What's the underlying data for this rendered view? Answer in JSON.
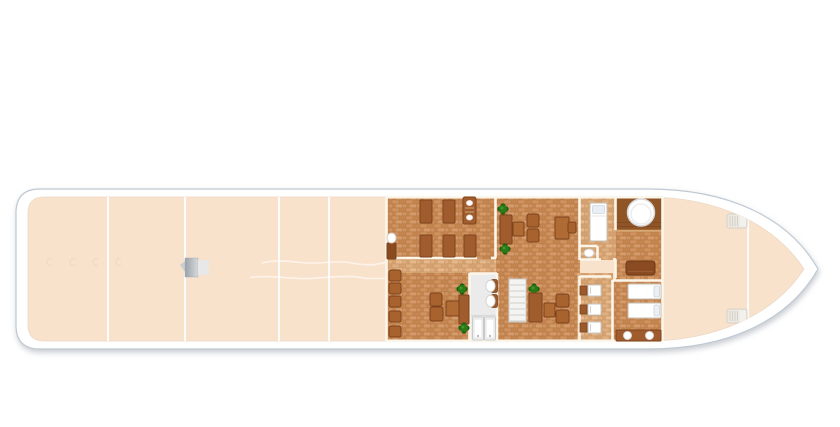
{
  "title": "river-ship-deck-floor-plan",
  "colors": {
    "page_bg": "#ffffff",
    "hull": "#ffffff",
    "hull_outline": "#bfc9d2",
    "deck": "#f9e2cc",
    "deck_line": "#ffffff",
    "deck_edge": "#ecd9c4",
    "wall": "#fcf6ea",
    "brick_medium_mortar": "#b87c48",
    "brick_medium_1": "#cf9260",
    "brick_medium_2": "#c5854f",
    "brick_medium_3": "#d49a6a",
    "brick_light_mortar": "#c99a68",
    "brick_light_1": "#e0af80",
    "brick_light_2": "#d6a170",
    "brick_light_3": "#e6b88c",
    "platform_dark": "#8f5527",
    "platform_plank": "#7c471f",
    "platform_edge": "#d8a873",
    "wood": "#a05c2c",
    "wood_dark": "#7d431c",
    "wood_chair": "#a7622e",
    "wood_table": "#b06a33",
    "wood_cabinet": "#8a4a1f",
    "sofa": "#8a4a22",
    "plant_green": "#2a7a18",
    "plant_green_dark": "#1e5c10",
    "white_fixture": "#ffffff",
    "fixture_stroke": "#c6beb2",
    "pillow_blue": "#e9eef4",
    "wc_floor": "#ebebeb",
    "stairs_fill": "#f4f4f2",
    "stairs_line": "#d2cec6",
    "winch_gray_1": "#9aa1a7",
    "winch_gray_2": "#d7dadd",
    "hatch_fill": "#ece9e2",
    "hatch_stroke": "#d6d1c7",
    "tie_mark": "#eed9bf"
  },
  "floorplan": {
    "canvas": {
      "w": 840,
      "h": 427
    },
    "ship": {
      "outer_path": "M 40,189 H 648 C 726,189 788,216 818,269 C 788,322 726,349 648,349 H 40 Q 16,349 16,325 V 213 Q 16,189 40,189 Z",
      "deck_path": "M 44,197 H 646 C 716,197 774,223 804,269 C 774,315 716,341 646,341 H 44 Q 28,341 28,325 V 213 Q 28,197 44,197 Z"
    },
    "deck": {
      "divider_x": [
        108,
        185,
        279,
        329
      ],
      "bow_line": {
        "x": 748,
        "y1": 210,
        "y2": 330
      },
      "lane_lines": [
        "M 262,263 c 15,-4 30,-1 45,0 s 30,-3 45,0 s 25,2 34,-1",
        "M 250,277.5 c 20,-3 40,2 60,1 s 40,-4 56,0 l 20,0"
      ],
      "tie_marks": [
        [
          50,
          262
        ],
        [
          73,
          262
        ],
        [
          96,
          262
        ],
        [
          119,
          262
        ]
      ],
      "winch": {
        "x": 185,
        "y": 258
      },
      "hatches": [
        [
          727,
          214
        ],
        [
          727,
          309
        ]
      ]
    },
    "rooms": [
      {
        "name": "saloon-benches-room",
        "floor": "medium",
        "rect": [
          387,
          197,
          109,
          62
        ]
      },
      {
        "name": "corridor-left",
        "floor": "light",
        "rect": [
          387,
          259,
          109,
          14
        ]
      },
      {
        "name": "lounge-lower-room",
        "floor": "medium",
        "rect": [
          387,
          273,
          109,
          68
        ]
      },
      {
        "name": "lounge-main-room",
        "floor": "medium",
        "rect": [
          496,
          197,
          84,
          144
        ]
      },
      {
        "name": "cabin",
        "floor": "light",
        "rect": [
          580,
          197,
          36,
          63
        ]
      },
      {
        "name": "aft-platform",
        "floor": "dark",
        "rect": [
          616,
          197,
          47,
          33
        ]
      },
      {
        "name": "sofa-area",
        "floor": "medium",
        "rect": [
          616,
          230,
          47,
          50
        ]
      },
      {
        "name": "corridor-right",
        "floor": "light",
        "rect": [
          577,
          273,
          36,
          68
        ]
      },
      {
        "name": "bedroom",
        "floor": "medium",
        "rect": [
          613,
          280,
          50,
          61
        ]
      },
      {
        "name": "washroom",
        "floor": "white",
        "rect": [
          470,
          273,
          27,
          68
        ]
      }
    ],
    "walls": [
      [
        386.5,
        197,
        386.5,
        341
      ],
      [
        387,
        258,
        477,
        258
      ],
      [
        491,
        258,
        496,
        258
      ],
      [
        495.5,
        197,
        495.5,
        258
      ],
      [
        579.5,
        197,
        579.5,
        260
      ],
      [
        580,
        246,
        597,
        246
      ],
      [
        597.5,
        246,
        597.5,
        260
      ],
      [
        580,
        259.5,
        601,
        259.5
      ],
      [
        613,
        259.5,
        616,
        259.5
      ],
      [
        615.5,
        197,
        615.5,
        230
      ],
      [
        615.5,
        259,
        615.5,
        278
      ],
      [
        579.5,
        276,
        579.5,
        341
      ],
      [
        579.5,
        276.5,
        611,
        276.5
      ],
      [
        612.5,
        280,
        612.5,
        341
      ],
      [
        612.5,
        280.5,
        663,
        280.5
      ],
      [
        469.5,
        273,
        469.5,
        341
      ],
      [
        497,
        273,
        497,
        341
      ],
      [
        469.5,
        273.5,
        497,
        273.5
      ],
      [
        386,
        340.8,
        663,
        340.8
      ],
      [
        386,
        197.2,
        663,
        197.2
      ],
      [
        662.5,
        197,
        662.5,
        341
      ]
    ],
    "thin_lines": [
      {
        "x1": 616,
        "y1": 222.5,
        "x2": 663,
        "y2": 222.5,
        "color": "#7c471f",
        "w": 0.8
      },
      {
        "x1": 616,
        "y1": 226.5,
        "x2": 663,
        "y2": 226.5,
        "color": "#7c471f",
        "w": 0.8
      },
      {
        "x1": 616,
        "y1": 230.8,
        "x2": 663,
        "y2": 230.8,
        "color": "#d8a873",
        "w": 2
      },
      {
        "x1": 470,
        "y1": 315.5,
        "x2": 497,
        "y2": 315.5,
        "color": "#d9d9d9",
        "w": 1.2
      }
    ],
    "furniture": [
      {
        "t": "bench",
        "r": [
          420,
          200,
          12,
          23
        ]
      },
      {
        "t": "bench",
        "r": [
          443,
          200,
          12,
          23
        ]
      },
      {
        "t": "lounger",
        "r": [
          463,
          197,
          13,
          27
        ]
      },
      {
        "t": "bench",
        "r": [
          420,
          235,
          12,
          22
        ]
      },
      {
        "t": "bench",
        "r": [
          443,
          235,
          12,
          22
        ]
      },
      {
        "t": "bench",
        "r": [
          464,
          235,
          12,
          22
        ]
      },
      {
        "t": "cabinet",
        "r": [
          387,
          243,
          9,
          16
        ]
      },
      {
        "t": "oval-table",
        "c": [
          391.5,
          238,
          4.5,
          5
        ]
      },
      {
        "t": "plant",
        "c": [
          503,
          209
        ]
      },
      {
        "t": "bench",
        "r": [
          500,
          215,
          12,
          29
        ]
      },
      {
        "t": "plant",
        "c": [
          505,
          249
        ]
      },
      {
        "t": "table",
        "r": [
          513,
          222,
          11,
          14
        ]
      },
      {
        "t": "chair",
        "r": [
          527,
          214,
          12,
          13
        ]
      },
      {
        "t": "chair",
        "r": [
          527,
          229,
          12,
          13
        ]
      },
      {
        "t": "table",
        "r": [
          555,
          217,
          14,
          22
        ]
      },
      {
        "t": "chair",
        "r": [
          568,
          222,
          8,
          11
        ]
      },
      {
        "t": "bed-v",
        "r": [
          590,
          203,
          17,
          38
        ]
      },
      {
        "t": "sink",
        "c": [
          589,
          253,
          5,
          4
        ]
      },
      {
        "t": "tub",
        "c": [
          641,
          212.5,
          13.5
        ]
      },
      {
        "t": "sofa",
        "r": [
          626,
          261,
          29,
          14
        ]
      },
      {
        "t": "basin",
        "r": [
          580,
          285,
          21,
          11
        ]
      },
      {
        "t": "basin",
        "r": [
          580,
          304,
          21,
          11
        ]
      },
      {
        "t": "basin",
        "r": [
          580,
          322,
          21,
          11
        ]
      },
      {
        "t": "bed-h",
        "r": [
          628,
          284,
          33,
          15
        ]
      },
      {
        "t": "bed-h",
        "r": [
          628,
          303,
          33,
          15
        ]
      },
      {
        "t": "counter",
        "r": [
          616,
          330,
          45,
          11
        ]
      },
      {
        "t": "stool",
        "r": [
          389,
          270,
          12,
          11
        ]
      },
      {
        "t": "stool",
        "r": [
          389,
          283,
          12,
          11
        ]
      },
      {
        "t": "stool",
        "r": [
          389,
          296,
          12,
          11
        ]
      },
      {
        "t": "stool",
        "r": [
          389,
          311,
          12,
          11
        ]
      },
      {
        "t": "stool",
        "r": [
          389,
          326,
          12,
          11
        ]
      },
      {
        "t": "chair",
        "r": [
          430,
          293,
          12,
          13
        ]
      },
      {
        "t": "chair",
        "r": [
          430,
          307,
          13,
          14
        ]
      },
      {
        "t": "table",
        "r": [
          446,
          301,
          13,
          15
        ]
      },
      {
        "t": "plant",
        "c": [
          462,
          289
        ]
      },
      {
        "t": "bar",
        "r": [
          459,
          295,
          10,
          29
        ]
      },
      {
        "t": "plant",
        "c": [
          464,
          328
        ]
      },
      {
        "t": "toilet",
        "r": [
          486,
          279,
          11,
          14
        ]
      },
      {
        "t": "toilet",
        "r": [
          486,
          294,
          11,
          14
        ]
      },
      {
        "t": "stall-door",
        "r": [
          472.5,
          317,
          11,
          23
        ]
      },
      {
        "t": "stall-door",
        "r": [
          484.5,
          317,
          11,
          23
        ]
      },
      {
        "t": "stairs",
        "r": [
          509,
          279,
          17,
          43
        ]
      },
      {
        "t": "plant",
        "c": [
          534,
          289
        ]
      },
      {
        "t": "bench",
        "r": [
          529,
          293,
          13,
          29
        ]
      },
      {
        "t": "table",
        "r": [
          544,
          303,
          11,
          14
        ]
      },
      {
        "t": "chair",
        "r": [
          556,
          294,
          13,
          13
        ]
      },
      {
        "t": "chair",
        "r": [
          556,
          310,
          13,
          13
        ]
      }
    ]
  }
}
